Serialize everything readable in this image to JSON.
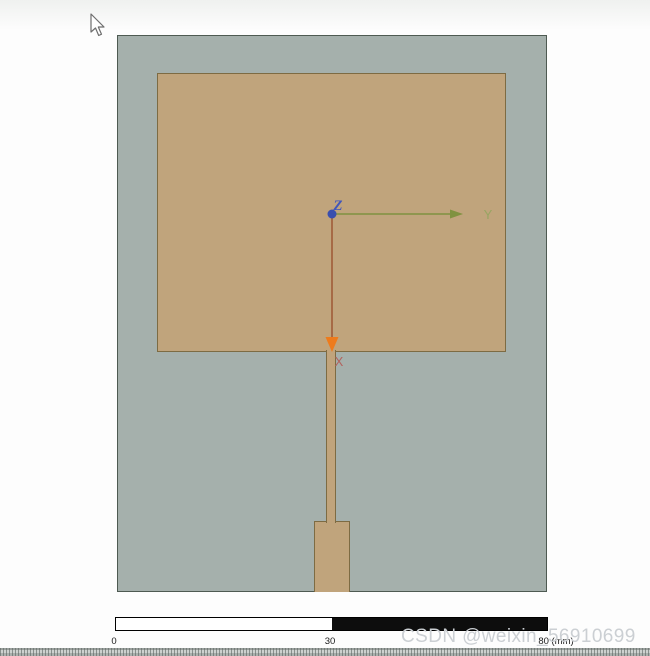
{
  "theme": {
    "canvas-top": "#eff1ef",
    "canvas-bg": "#fdfdfd",
    "substrate-fill": "#a5b0ac",
    "substrate-border": "#4e5a52",
    "patch-fill": "#c0a47c",
    "patch-border": "#7d6b43",
    "x-line": "#a05c38",
    "x-arrow": "#ee7b1c",
    "x-label": "#b2625c",
    "y-line": "#7f9240",
    "y-label": "#97a562",
    "z-dot": "#3a4fae",
    "z-label": "#4056bc",
    "scale-black": "#0d0d0d",
    "watermark": "#cbcfd3"
  },
  "axes": {
    "x": "X",
    "y": "Y",
    "z": "Z"
  },
  "scale_bar": {
    "start": "0",
    "mid": "30",
    "end": "80 (mm)"
  },
  "watermark": {
    "text": "CSDN @weixin_56910699"
  }
}
